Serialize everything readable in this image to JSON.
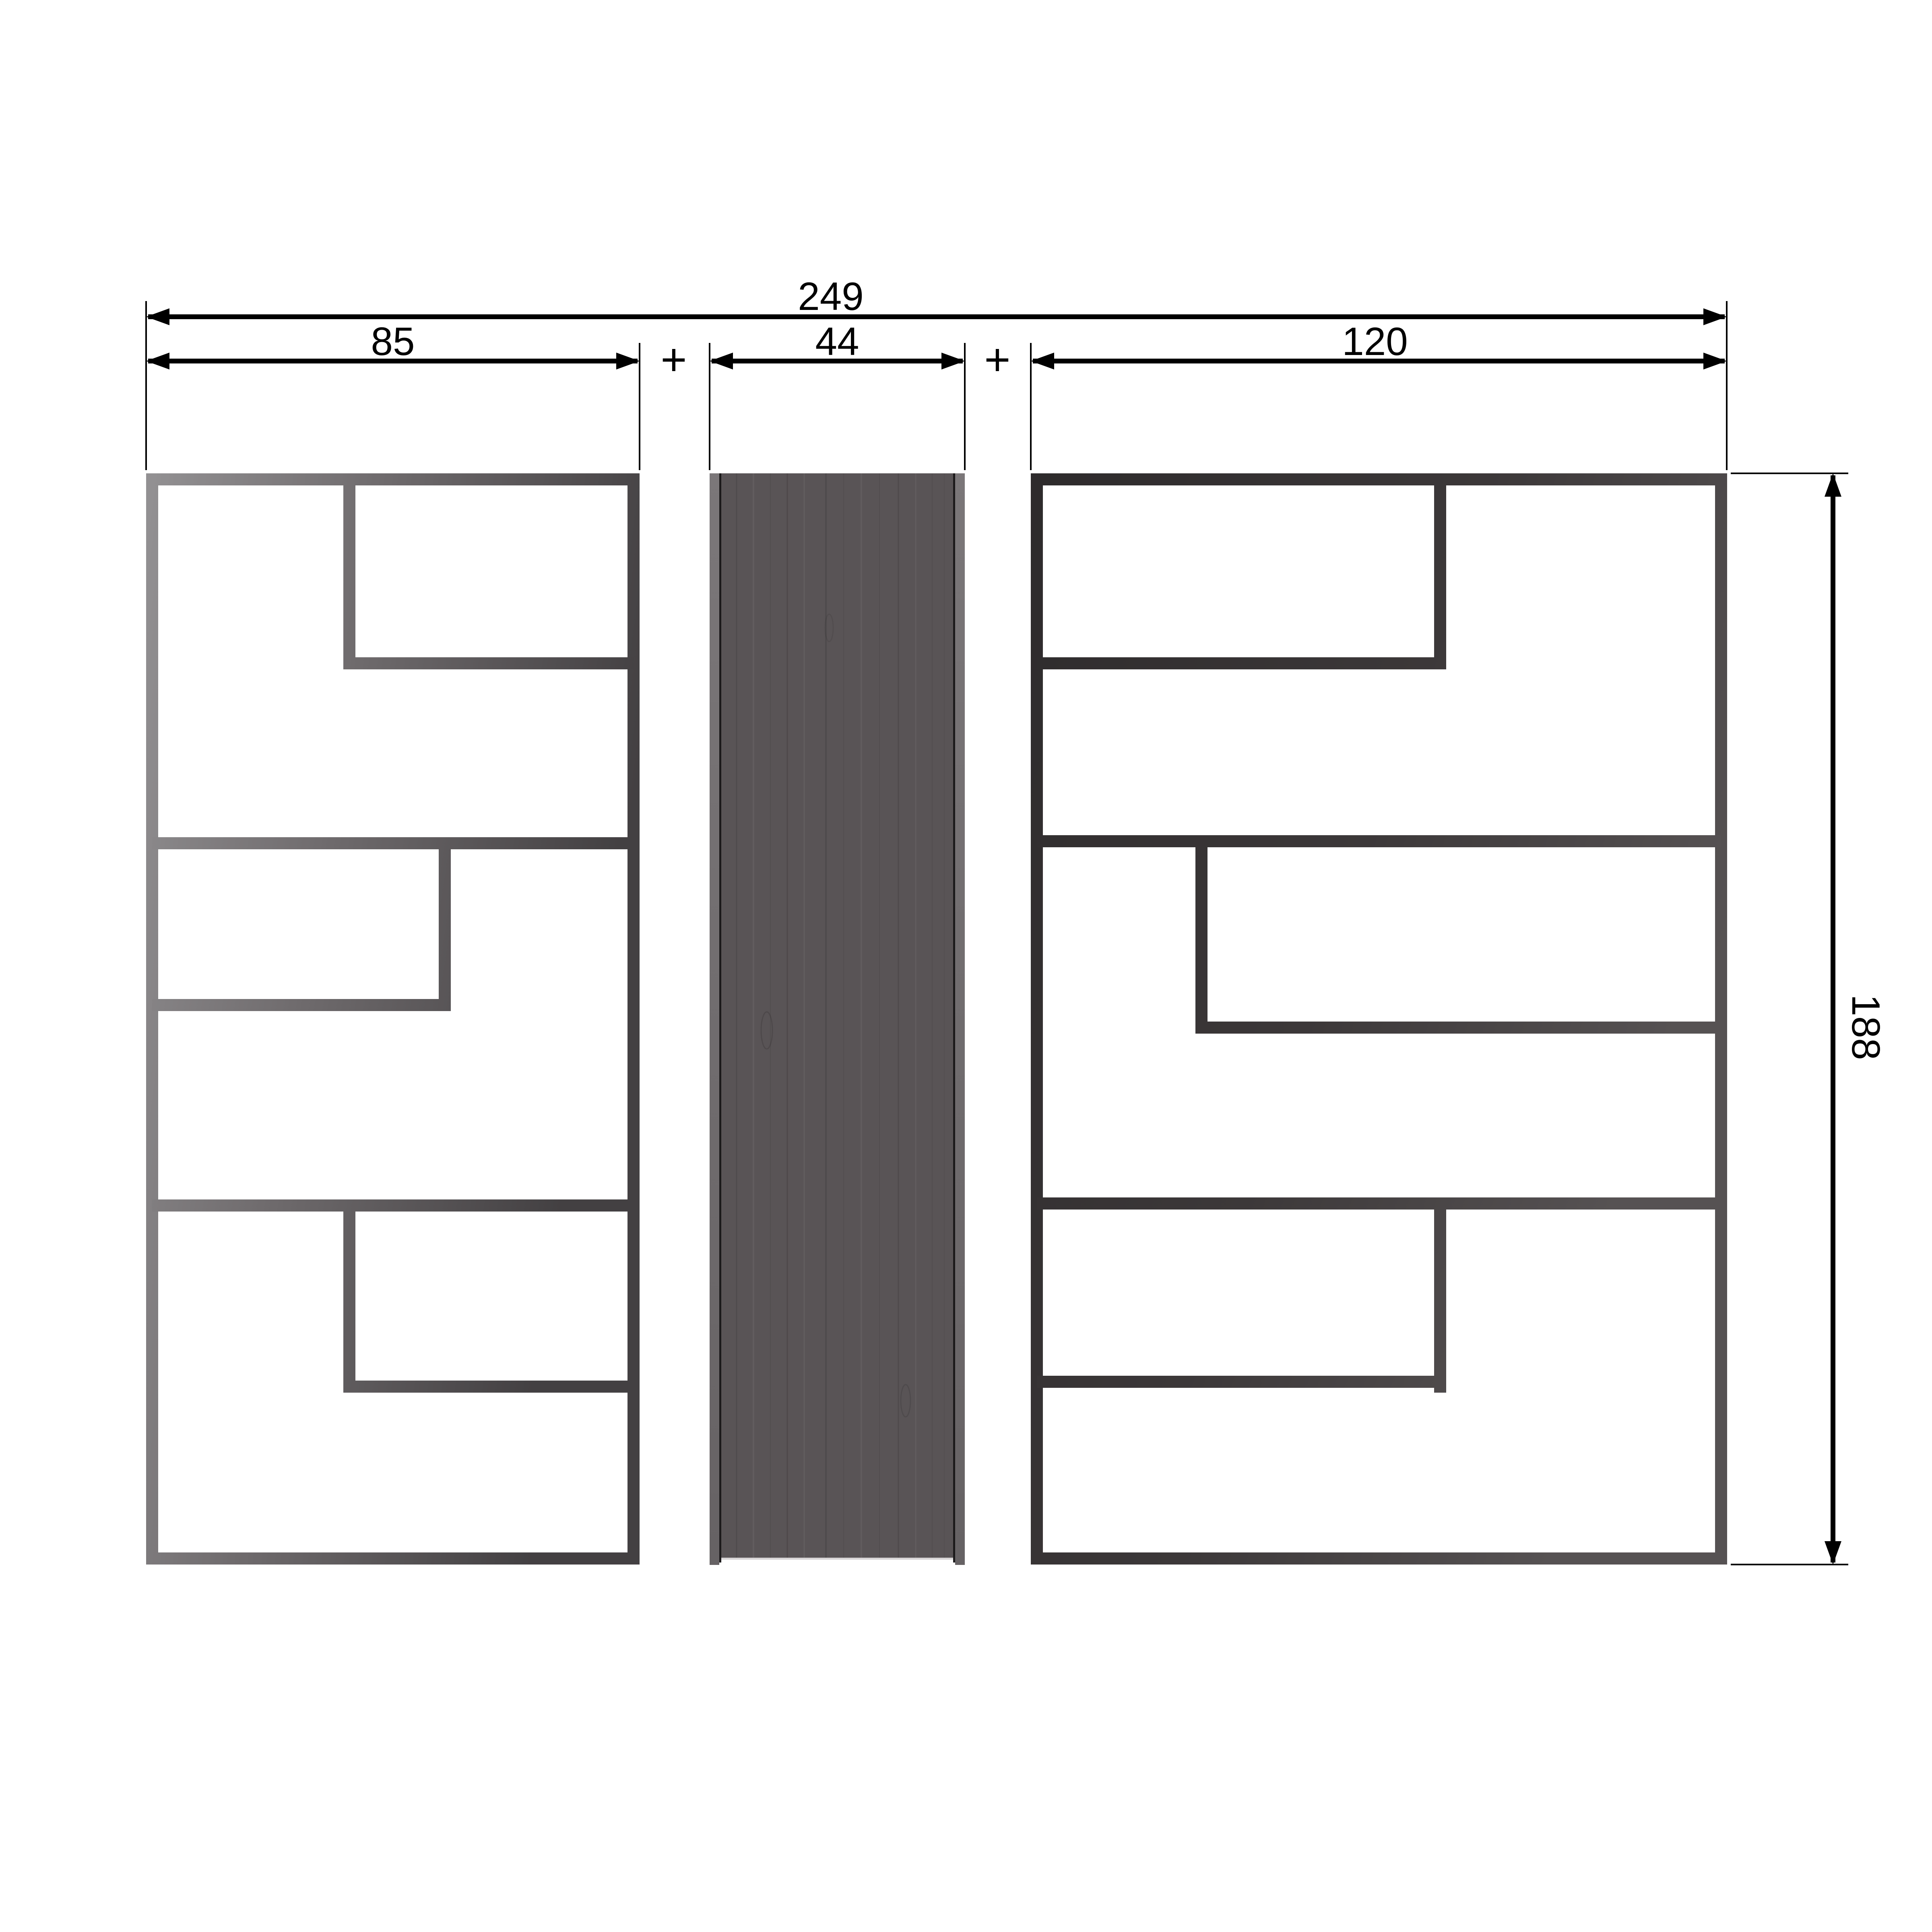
{
  "drawing": {
    "type": "furniture-dimension-drawing",
    "dims": {
      "total_width": "249",
      "left_unit_width": "85",
      "center_panel_width": "44",
      "right_unit_width": "120",
      "height": "188",
      "plus": "+"
    },
    "colors": {
      "background": "#ffffff",
      "dimension": "#000000",
      "left_frame_light": "#929092",
      "left_frame_mid": "#6e6a6c",
      "left_frame_dark": "#434042",
      "right_frame_dark": "#2e2b2c",
      "right_frame_mid": "#3c3839",
      "right_frame_light": "#565253",
      "panel_body": "#595456",
      "panel_edge_light": "#7b7779",
      "panel_edge_dark": "#666264",
      "panel_edge_line": "#1c1a1b",
      "panel_base_highlight": "#d8d5d6"
    }
  }
}
